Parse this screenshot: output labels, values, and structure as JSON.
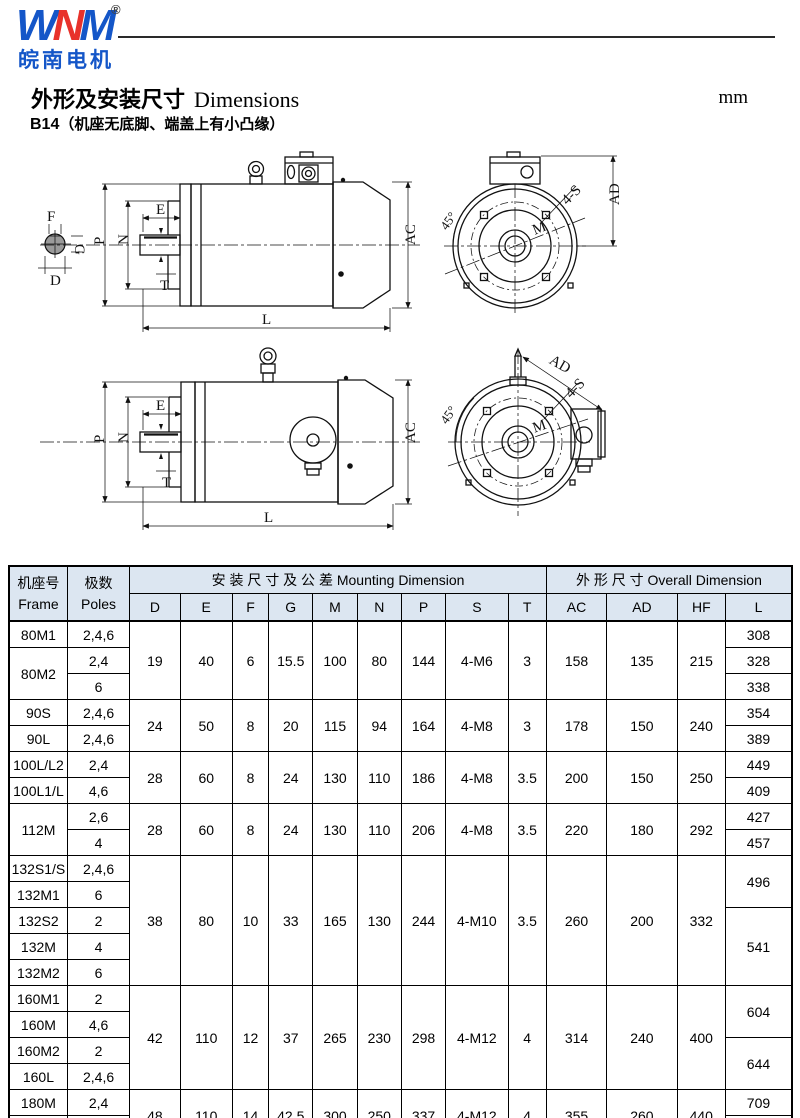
{
  "colors": {
    "brand_blue": "#1456c8",
    "brand_red": "#e8322b",
    "table_header_bg": "#dce6f1"
  },
  "logo": {
    "brand_w": "W",
    "brand_n": "N",
    "brand_m": "M",
    "registered": "®",
    "company": "皖南电机"
  },
  "title": {
    "zh": "外形及安装尺寸",
    "en": "Dimensions",
    "unit": "mm"
  },
  "subtitle": {
    "model": "B14",
    "note": "（机座无底脚、端盖上有小凸缘）"
  },
  "drawings": {
    "labels": {
      "F": "F",
      "G": "G",
      "D": "D",
      "E": "E",
      "P": "P",
      "N": "N",
      "T": "T",
      "L": "L",
      "AC": "AC",
      "AD": "AD",
      "M": "M",
      "angle": "45°",
      "holes": "4-S"
    }
  },
  "table": {
    "headers": {
      "frame_zh": "机座号",
      "frame_en": "Frame",
      "poles_zh": "极数",
      "poles_en": "Poles",
      "mounting_zh": "安 装 尺 寸 及 公 差",
      "mounting_en": "Mounting Dimension",
      "overall_zh": "外 形 尺 寸",
      "overall_en": "Overall Dimension"
    },
    "mount_cols": [
      "D",
      "E",
      "F",
      "G",
      "M",
      "N",
      "P",
      "S",
      "T"
    ],
    "overall_cols": [
      "AC",
      "AD",
      "HF",
      "L"
    ],
    "rows": [
      [
        {
          "t": "80M1"
        },
        {
          "t": "2,4,6"
        },
        {
          "t": "19",
          "rs": 3
        },
        {
          "t": "40",
          "rs": 3
        },
        {
          "t": "6",
          "rs": 3
        },
        {
          "t": "15.5",
          "rs": 3
        },
        {
          "t": "100",
          "rs": 3
        },
        {
          "t": "80",
          "rs": 3
        },
        {
          "t": "144",
          "rs": 3
        },
        {
          "t": "4-M6",
          "rs": 3
        },
        {
          "t": "3",
          "rs": 3
        },
        {
          "t": "158",
          "rs": 3
        },
        {
          "t": "135",
          "rs": 3
        },
        {
          "t": "215",
          "rs": 3
        },
        {
          "t": "308"
        }
      ],
      [
        {
          "t": "80M2",
          "rs": 2
        },
        {
          "t": "2,4"
        },
        {
          "t": "328"
        }
      ],
      [
        {
          "t": "6"
        },
        {
          "t": "338"
        }
      ],
      [
        {
          "t": "90S"
        },
        {
          "t": "2,4,6"
        },
        {
          "t": "24",
          "rs": 2
        },
        {
          "t": "50",
          "rs": 2
        },
        {
          "t": "8",
          "rs": 2
        },
        {
          "t": "20",
          "rs": 2
        },
        {
          "t": "115",
          "rs": 2
        },
        {
          "t": "94",
          "rs": 2
        },
        {
          "t": "164",
          "rs": 2
        },
        {
          "t": "4-M8",
          "rs": 2
        },
        {
          "t": "3",
          "rs": 2
        },
        {
          "t": "178",
          "rs": 2
        },
        {
          "t": "150",
          "rs": 2
        },
        {
          "t": "240",
          "rs": 2
        },
        {
          "t": "354"
        }
      ],
      [
        {
          "t": "90L"
        },
        {
          "t": "2,4,6"
        },
        {
          "t": "389"
        }
      ],
      [
        {
          "t": "100L/L2"
        },
        {
          "t": "2,4"
        },
        {
          "t": "28",
          "rs": 2
        },
        {
          "t": "60",
          "rs": 2
        },
        {
          "t": "8",
          "rs": 2
        },
        {
          "t": "24",
          "rs": 2
        },
        {
          "t": "130",
          "rs": 2
        },
        {
          "t": "110",
          "rs": 2
        },
        {
          "t": "186",
          "rs": 2
        },
        {
          "t": "4-M8",
          "rs": 2
        },
        {
          "t": "3.5",
          "rs": 2
        },
        {
          "t": "200",
          "rs": 2
        },
        {
          "t": "150",
          "rs": 2
        },
        {
          "t": "250",
          "rs": 2
        },
        {
          "t": "449"
        }
      ],
      [
        {
          "t": "100L1/L"
        },
        {
          "t": "4,6"
        },
        {
          "t": "409"
        }
      ],
      [
        {
          "t": "112M",
          "rs": 2
        },
        {
          "t": "2,6"
        },
        {
          "t": "28",
          "rs": 2
        },
        {
          "t": "60",
          "rs": 2
        },
        {
          "t": "8",
          "rs": 2
        },
        {
          "t": "24",
          "rs": 2
        },
        {
          "t": "130",
          "rs": 2
        },
        {
          "t": "110",
          "rs": 2
        },
        {
          "t": "206",
          "rs": 2
        },
        {
          "t": "4-M8",
          "rs": 2
        },
        {
          "t": "3.5",
          "rs": 2
        },
        {
          "t": "220",
          "rs": 2
        },
        {
          "t": "180",
          "rs": 2
        },
        {
          "t": "292",
          "rs": 2
        },
        {
          "t": "427"
        }
      ],
      [
        {
          "t": "4"
        },
        {
          "t": "457"
        }
      ],
      [
        {
          "t": "132S1/S"
        },
        {
          "t": "2,4,6"
        },
        {
          "t": "38",
          "rs": 5
        },
        {
          "t": "80",
          "rs": 5
        },
        {
          "t": "10",
          "rs": 5
        },
        {
          "t": "33",
          "rs": 5
        },
        {
          "t": "165",
          "rs": 5
        },
        {
          "t": "130",
          "rs": 5
        },
        {
          "t": "244",
          "rs": 5
        },
        {
          "t": "4-M10",
          "rs": 5
        },
        {
          "t": "3.5",
          "rs": 5
        },
        {
          "t": "260",
          "rs": 5
        },
        {
          "t": "200",
          "rs": 5
        },
        {
          "t": "332",
          "rs": 5
        },
        {
          "t": "496",
          "rs": 2
        }
      ],
      [
        {
          "t": "132M1"
        },
        {
          "t": "6"
        }
      ],
      [
        {
          "t": "132S2"
        },
        {
          "t": "2"
        },
        {
          "t": "541",
          "rs": 3
        }
      ],
      [
        {
          "t": "132M"
        },
        {
          "t": "4"
        }
      ],
      [
        {
          "t": "132M2"
        },
        {
          "t": "6"
        }
      ],
      [
        {
          "t": "160M1"
        },
        {
          "t": "2"
        },
        {
          "t": "42",
          "rs": 4
        },
        {
          "t": "110",
          "rs": 4
        },
        {
          "t": "12",
          "rs": 4
        },
        {
          "t": "37",
          "rs": 4
        },
        {
          "t": "265",
          "rs": 4
        },
        {
          "t": "230",
          "rs": 4
        },
        {
          "t": "298",
          "rs": 4
        },
        {
          "t": "4-M12",
          "rs": 4
        },
        {
          "t": "4",
          "rs": 4
        },
        {
          "t": "314",
          "rs": 4
        },
        {
          "t": "240",
          "rs": 4
        },
        {
          "t": "400",
          "rs": 4
        },
        {
          "t": "604",
          "rs": 2
        }
      ],
      [
        {
          "t": "160M"
        },
        {
          "t": "4,6"
        }
      ],
      [
        {
          "t": "160M2"
        },
        {
          "t": "2"
        },
        {
          "t": "644",
          "rs": 2
        }
      ],
      [
        {
          "t": "160L"
        },
        {
          "t": "2,4,6"
        }
      ],
      [
        {
          "t": "180M"
        },
        {
          "t": "2,4"
        },
        {
          "t": "48",
          "rs": 2
        },
        {
          "t": "110",
          "rs": 2
        },
        {
          "t": "14",
          "rs": 2
        },
        {
          "t": "42.5",
          "rs": 2
        },
        {
          "t": "300",
          "rs": 2
        },
        {
          "t": "250",
          "rs": 2
        },
        {
          "t": "337",
          "rs": 2
        },
        {
          "t": "4-M12",
          "rs": 2
        },
        {
          "t": "4",
          "rs": 2
        },
        {
          "t": "355",
          "rs": 2
        },
        {
          "t": "260",
          "rs": 2
        },
        {
          "t": "440",
          "rs": 2
        },
        {
          "t": "709"
        }
      ],
      [
        {
          "t": "180L"
        },
        {
          "t": "4,6"
        },
        {
          "t": "734"
        }
      ]
    ]
  }
}
